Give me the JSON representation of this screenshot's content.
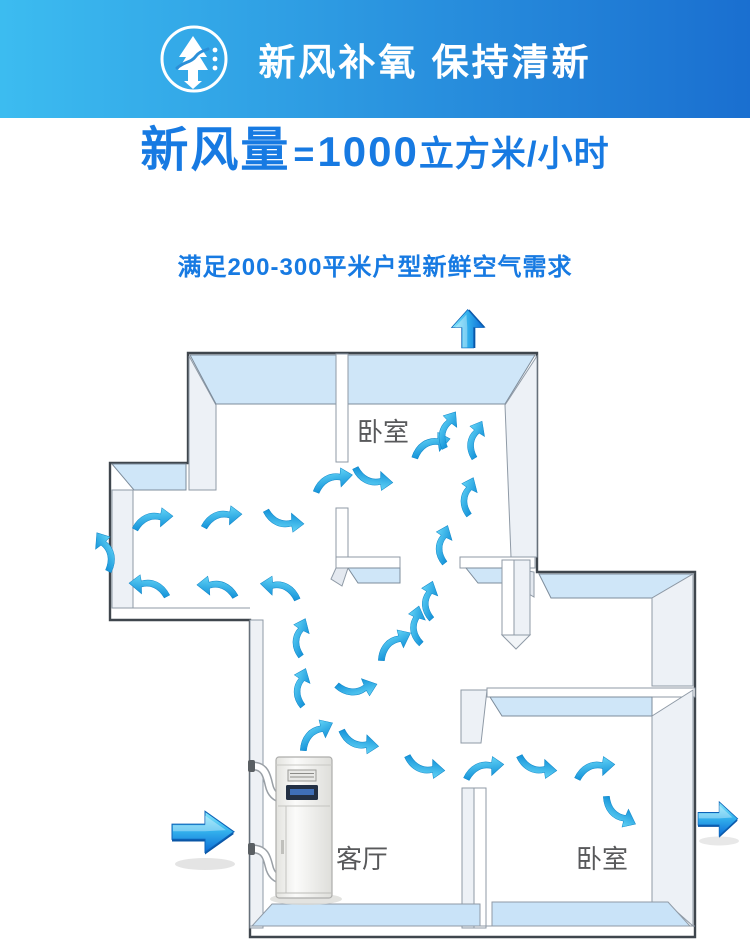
{
  "header": {
    "title": "新风补氧 保持清新",
    "icon": "tree-wind-icon",
    "bg_gradient": [
      "#3cbcf0",
      "#1a6fd0"
    ],
    "text_color": "#ffffff"
  },
  "headline": {
    "prefix": "新风量",
    "equals": "=",
    "value": "1000",
    "unit": "立方米/小时",
    "color": "#177ae2"
  },
  "subtitle": {
    "text": "满足200-300平米户型新鲜空气需求",
    "color": "#177ae2"
  },
  "floorplan": {
    "rooms": [
      {
        "id": "bedroom-top",
        "label": "卧室",
        "x": 383,
        "y": 441
      },
      {
        "id": "living-room",
        "label": "客厅",
        "x": 362,
        "y": 868
      },
      {
        "id": "bedroom-bottom",
        "label": "卧室",
        "x": 602,
        "y": 868
      }
    ],
    "device": {
      "name": "fresh-air-ventilation-unit"
    },
    "colors": {
      "outline": "#3f464d",
      "wall_face_blue": "#cfe6f8",
      "wall_face_gray": "#edf1f6",
      "floor_blue": "#c9e3f8",
      "flow_arrow": "#29a7e6",
      "big_arrow_light": "#8deafc",
      "big_arrow_dark": "#0c6cd6"
    },
    "flow_arrows": [
      {
        "x": 150,
        "y": 587,
        "r": 6,
        "sx": -0.85,
        "sy": 0.85
      },
      {
        "x": 218,
        "y": 588,
        "r": 4,
        "sx": -0.85,
        "sy": 0.85
      },
      {
        "x": 281,
        "y": 589,
        "r": 10,
        "sx": -0.85,
        "sy": 0.85
      },
      {
        "x": 106,
        "y": 552,
        "r": 60,
        "sx": -0.85,
        "sy": 0.85
      },
      {
        "x": 152,
        "y": 520,
        "r": -6,
        "sx": 0.85,
        "sy": 0.85
      },
      {
        "x": 221,
        "y": 518,
        "r": -6,
        "sx": 0.85,
        "sy": 0.85
      },
      {
        "x": 283,
        "y": 520,
        "r": 6,
        "sx": 0.85,
        "sy": -0.85
      },
      {
        "x": 332,
        "y": 481,
        "r": -12,
        "sx": 0.85,
        "sy": 0.85
      },
      {
        "x": 372,
        "y": 478,
        "r": 8,
        "sx": 0.85,
        "sy": -0.85
      },
      {
        "x": 430,
        "y": 446,
        "r": -15,
        "sx": 0.85,
        "sy": 0.85
      },
      {
        "x": 447,
        "y": 430,
        "r": -60,
        "sx": 0.8,
        "sy": 0.8
      },
      {
        "x": 475,
        "y": 440,
        "r": -65,
        "sx": 0.8,
        "sy": 0.8
      },
      {
        "x": 468,
        "y": 497,
        "r": -70,
        "sx": 0.8,
        "sy": 0.8
      },
      {
        "x": 443,
        "y": 545,
        "r": -72,
        "sx": 0.8,
        "sy": 0.8
      },
      {
        "x": 429,
        "y": 601,
        "r": -75,
        "sx": 0.8,
        "sy": 0.8
      },
      {
        "x": 417,
        "y": 626,
        "r": -80,
        "sx": 0.8,
        "sy": 0.8
      },
      {
        "x": 393,
        "y": 645,
        "r": -30,
        "sx": 0.85,
        "sy": 0.85
      },
      {
        "x": 300,
        "y": 638,
        "r": -70,
        "sx": 0.8,
        "sy": 0.8
      },
      {
        "x": 301,
        "y": 688,
        "r": -72,
        "sx": 0.8,
        "sy": 0.8
      },
      {
        "x": 356,
        "y": 688,
        "r": -15,
        "sx": 0.85,
        "sy": -0.85
      },
      {
        "x": 315,
        "y": 735,
        "r": -30,
        "sx": 0.85,
        "sy": 0.85
      },
      {
        "x": 358,
        "y": 741,
        "r": 10,
        "sx": 0.85,
        "sy": -0.85
      },
      {
        "x": 424,
        "y": 766,
        "r": 8,
        "sx": 0.85,
        "sy": -0.85
      },
      {
        "x": 483,
        "y": 769,
        "r": -8,
        "sx": 0.85,
        "sy": 0.85
      },
      {
        "x": 536,
        "y": 766,
        "r": 8,
        "sx": 0.85,
        "sy": -0.85
      },
      {
        "x": 594,
        "y": 769,
        "r": -8,
        "sx": 0.85,
        "sy": 0.85
      },
      {
        "x": 618,
        "y": 812,
        "r": 30,
        "sx": 0.85,
        "sy": -0.85
      }
    ],
    "big_arrows": [
      {
        "name": "intake-arrow-left",
        "x": 172,
        "y": 808,
        "rot": 0,
        "sx": 1.0,
        "sy": 1.08
      },
      {
        "name": "exhaust-arrow-top",
        "x": 449,
        "y": 348,
        "rot": -90,
        "sx": 0.62,
        "sy": 0.85
      },
      {
        "name": "exhaust-arrow-right",
        "x": 698,
        "y": 799,
        "rot": 0,
        "sx": 0.64,
        "sy": 0.9
      }
    ]
  }
}
